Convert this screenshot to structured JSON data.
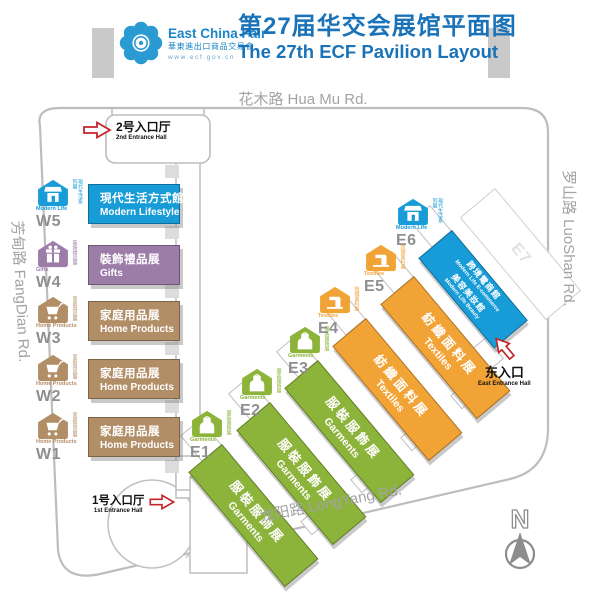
{
  "header": {
    "brand_en": "East China Fair",
    "brand_cn": "華東進出口商品交易會",
    "brand_url": "www.ecf.gov.cn",
    "title_cn": "第27届华交会展馆平面图",
    "title_en": "The 27th ECF Pavilion Layout"
  },
  "roads": {
    "top": "花木路 Hua Mu Rd.",
    "right": "罗山路 LuoShan Rd.",
    "left": "芳甸路 FangDian Rd.",
    "bottom": "龙阳路 LongYang Rd."
  },
  "entrances": {
    "second": {
      "cn": "2号入口厅",
      "en": "2nd Entrance Hall"
    },
    "first": {
      "cn": "1号入口厅",
      "en": "1st Entrance Hall"
    },
    "east": {
      "cn": "东入口",
      "en": "East Entrance Hall"
    }
  },
  "west_halls": [
    {
      "code": "W5",
      "title_cn": "現代生活方式館",
      "title_en": "Modern Lifestyle",
      "color": "#189CD8",
      "icon": "storefront-icon",
      "icon_caption": "Modern Life",
      "side_label": "現代生活系列展"
    },
    {
      "code": "W4",
      "title_cn": "裝飾禮品展",
      "title_en": "Gifts",
      "color": "#9B7DA8",
      "icon": "gift-icon",
      "icon_caption": "Gifts",
      "side_label": "裝飾禮品展"
    },
    {
      "code": "W3",
      "title_cn": "家庭用品展",
      "title_en": "Home Products",
      "color": "#B28E66",
      "icon": "cart-icon",
      "icon_caption": "Home Products",
      "side_label": "家庭用品展"
    },
    {
      "code": "W2",
      "title_cn": "家庭用品展",
      "title_en": "Home Products",
      "color": "#B28E66",
      "icon": "cart-icon",
      "icon_caption": "Home Products",
      "side_label": "家庭用品展"
    },
    {
      "code": "W1",
      "title_cn": "家庭用品展",
      "title_en": "Home Products",
      "color": "#B28E66",
      "icon": "cart-icon",
      "icon_caption": "Home Products",
      "side_label": "家庭用品展"
    }
  ],
  "east_halls": [
    {
      "code": "E1",
      "title_cn": "服裝服飾展",
      "title_en": "Garments",
      "color": "#8CB43A",
      "icon": "apron-icon",
      "icon_caption": "Garments",
      "side_label": "服裝服飾展"
    },
    {
      "code": "E2",
      "title_cn": "服裝服飾展",
      "title_en": "Garments",
      "color": "#8CB43A",
      "icon": "apron-icon",
      "icon_caption": "Garments",
      "side_label": "服裝服飾展"
    },
    {
      "code": "E3",
      "title_cn": "服裝服飾展",
      "title_en": "Garments",
      "color": "#8CB43A",
      "icon": "apron-icon",
      "icon_caption": "Garments",
      "side_label": "服裝服飾展"
    },
    {
      "code": "E4",
      "title_cn": "紡織面料展",
      "title_en": "Textiles",
      "color": "#F2A336",
      "icon": "sewing-machine-icon",
      "icon_caption": "Textiles",
      "side_label": "紡織面料展"
    },
    {
      "code": "E5",
      "title_cn": "紡織面料展",
      "title_en": "Textiles",
      "color": "#F2A336",
      "icon": "sewing-machine-icon",
      "icon_caption": "Textiles",
      "side_label": "紡織面料展"
    },
    {
      "code": "E6",
      "color": "#189CD8",
      "icon": "storefront-icon",
      "icon_caption": "Modern Life",
      "side_label": "現代生活系列展",
      "line1_cn": "跨境電商館",
      "line1_en": "Modern Life E-commerce",
      "line2_cn": "美容美妝館",
      "line2_en": "Modern Life Beauty"
    }
  ],
  "ghost_hall": {
    "code": "E7"
  },
  "compass": {
    "label": "N"
  },
  "colors": {
    "blue": "#189CD8",
    "purple": "#9B7DA8",
    "tan": "#B28E66",
    "green": "#8CB43A",
    "orange": "#F2A336",
    "header_blue": "#1A73B8",
    "road_gray": "#A3A3A3",
    "arrow_red": "#C4242B"
  }
}
